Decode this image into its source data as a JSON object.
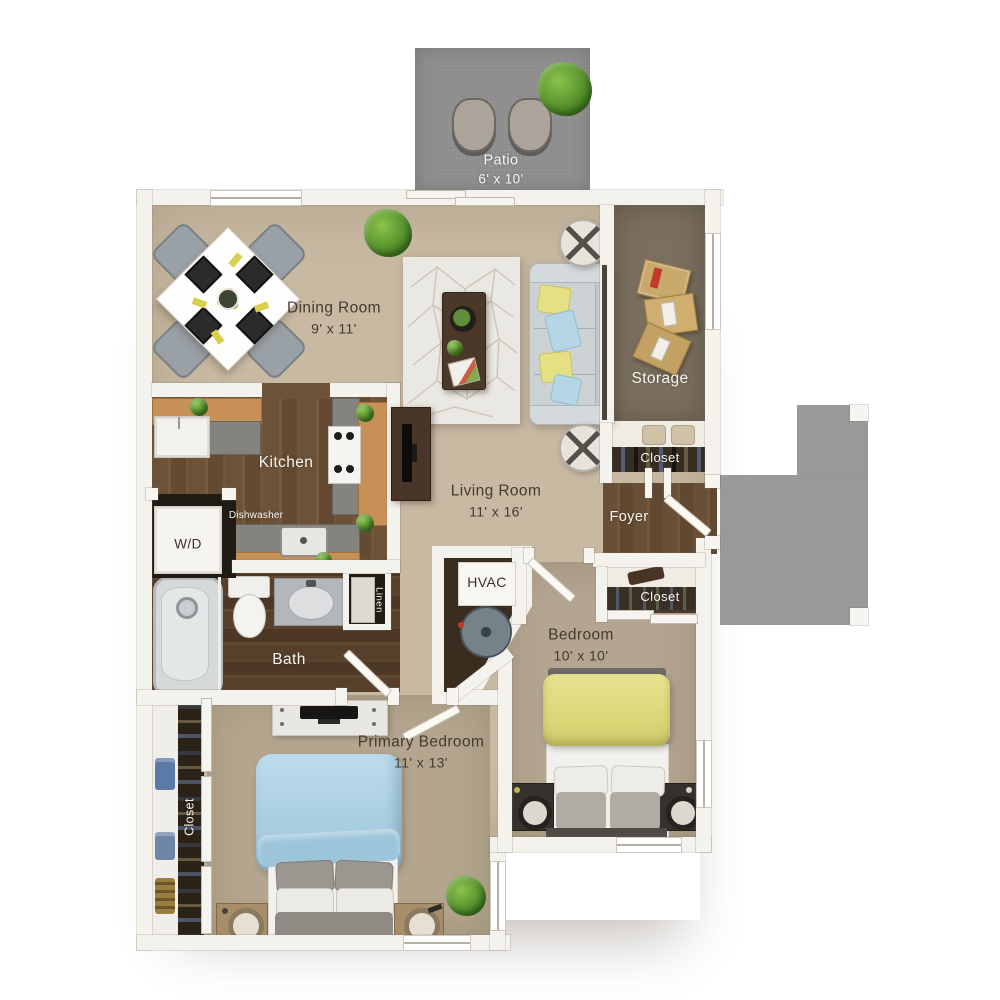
{
  "plan_title": "Two bedroom apartment floor plan",
  "patio": {
    "name": "Patio",
    "dims": "6' x 10'"
  },
  "dining_room": {
    "name": "Dining Room",
    "dims": "9' x 11'"
  },
  "kitchen": {
    "name": "Kitchen",
    "dishwasher_label": "Dishwasher",
    "washer_dryer_label": "W/D"
  },
  "living_room": {
    "name": "Living Room",
    "dims": "11' x 16'"
  },
  "storage": {
    "name": "Storage"
  },
  "coat_closet": {
    "name": "Closet"
  },
  "foyer": {
    "name": "Foyer"
  },
  "foyer_closet": {
    "name": "Closet"
  },
  "hvac": {
    "name": "HVAC"
  },
  "bath": {
    "name": "Bath",
    "linen_label": "Linen"
  },
  "bedroom": {
    "name": "Bedroom",
    "dims": "10' x 10'"
  },
  "primary_bedroom": {
    "name": "Primary Bedroom",
    "dims": "11' x 13'"
  },
  "primary_closet": {
    "name": "Closet"
  },
  "colors": {
    "wall": "#f4f2ec",
    "carpet_main": "#c8b9a2",
    "carpet_bedroom": "#b9ab94",
    "wood_kitchen": "#6d5238",
    "wood_bath": "#56402c",
    "storage_floor": "#7b7060",
    "concrete": "#8f8f8f",
    "accent_yellow": "#dfdb80",
    "accent_blue": "#abcfe2"
  }
}
